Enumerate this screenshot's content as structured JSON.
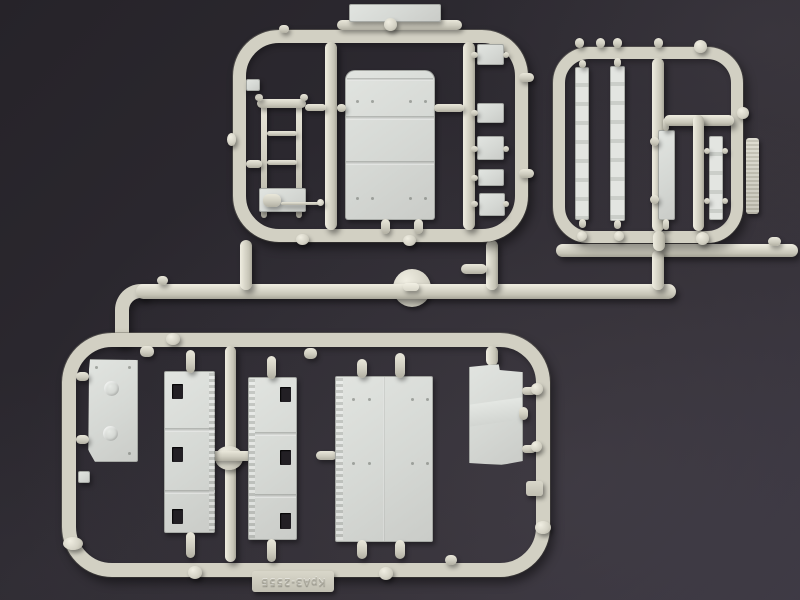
{
  "scene": {
    "description": "Photograph of light-grey injection-moulded plastic model-kit sprues (runner frames with truck parts) lying on a dark grey studio surface",
    "background_color": "#312e35",
    "sprue_color": "#d2d0c3",
    "part_color": "#d6d9d5",
    "shadow_color": "rgba(0,0,0,0.45)"
  },
  "sprues": {
    "top_left": {
      "name": "top-left sprue"
    },
    "top_right": {
      "name": "top-right sprue",
      "tag_text": ""
    },
    "bottom": {
      "name": "bottom sprue",
      "tag_text": "КрАЗ-255Б"
    }
  }
}
